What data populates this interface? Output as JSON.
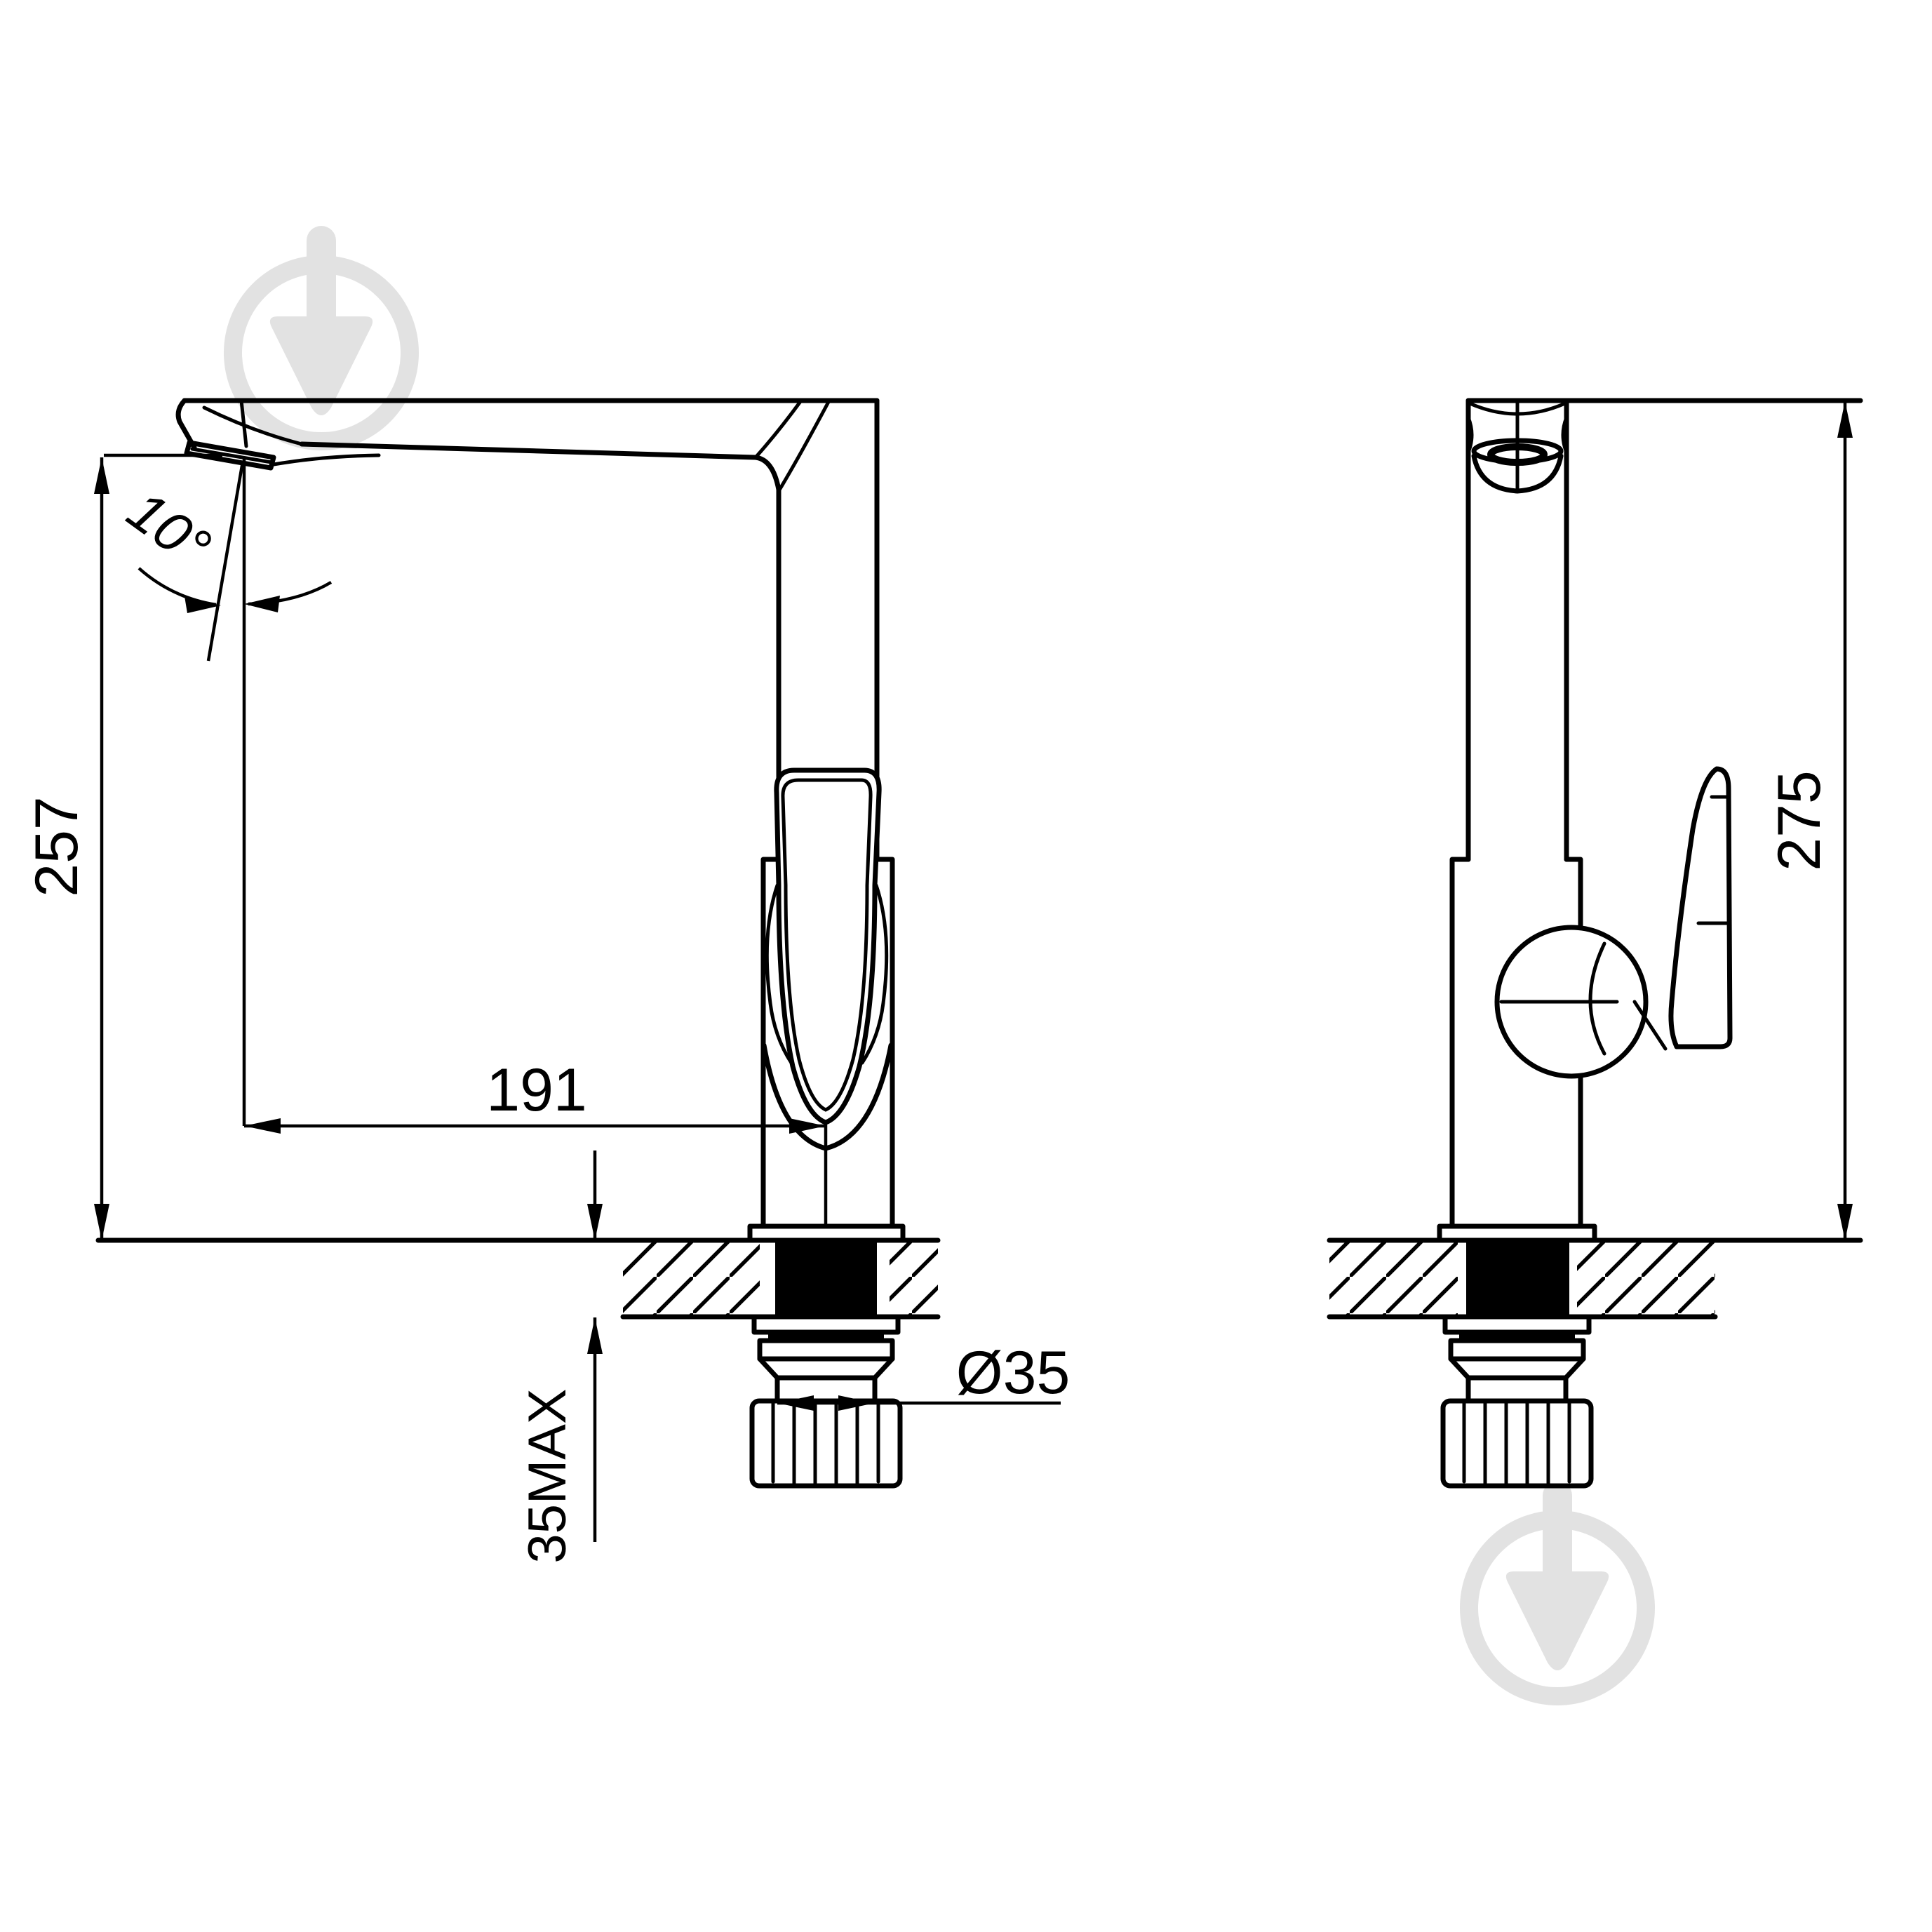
{
  "page": {
    "background": "#ffffff",
    "line_color": "#000000",
    "watermark_color": "#e2e2e2"
  },
  "drawing": {
    "side_view": {
      "dim_spout_height": "257",
      "dim_spout_reach": "191",
      "dim_spout_angle": "10°",
      "dim_deck_thickness": "35MAX",
      "dim_hole_diameter": "Ø35"
    },
    "front_view": {
      "dim_total_height": "275"
    }
  }
}
